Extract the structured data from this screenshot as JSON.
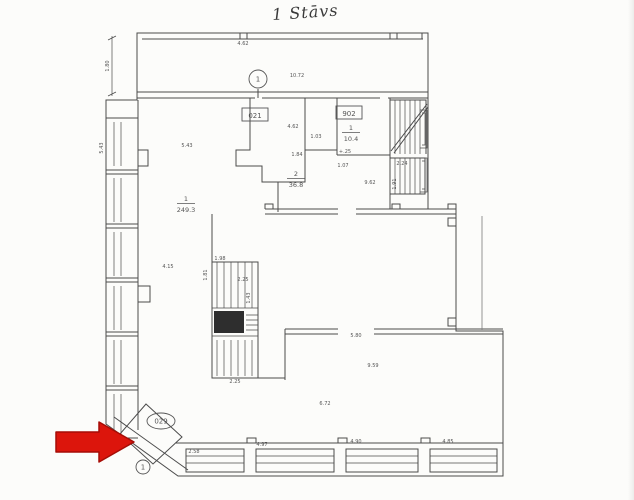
{
  "page": {
    "background": "#fcfcfa",
    "title": "1 Stāvs"
  },
  "plan": {
    "ink": "#4b4b4b",
    "label_color": "#555555",
    "rooms": [
      {
        "number": "1",
        "area": "10.4",
        "x": 351,
        "y": 130,
        "note": "+.25"
      },
      {
        "number": "2",
        "area": "36.8",
        "x": 296,
        "y": 176
      },
      {
        "number": "1",
        "area": "249.3",
        "x": 186,
        "y": 201
      }
    ],
    "boxed_labels": [
      {
        "text": "021",
        "x": 255,
        "y": 114
      },
      {
        "text": "902",
        "x": 349,
        "y": 112
      }
    ],
    "oval_labels": [
      {
        "text": "029",
        "x": 161,
        "y": 421
      }
    ],
    "circle_markers": [
      {
        "text": "1",
        "x": 258,
        "y": 79,
        "r": 9
      },
      {
        "text": "1",
        "x": 143,
        "y": 467,
        "r": 7
      }
    ],
    "dims": [
      {
        "t": "10.72",
        "x": 297,
        "y": 77
      },
      {
        "t": "4.62",
        "x": 243,
        "y": 45
      },
      {
        "t": "1.80",
        "x": 109,
        "y": 66,
        "r": -90
      },
      {
        "t": "5.43",
        "x": 103,
        "y": 148,
        "r": -90
      },
      {
        "t": "4.62",
        "x": 293,
        "y": 128
      },
      {
        "t": "1.03",
        "x": 316,
        "y": 138
      },
      {
        "t": "1.84",
        "x": 297,
        "y": 156
      },
      {
        "t": "5.43",
        "x": 187,
        "y": 147
      },
      {
        "t": "1.07",
        "x": 343,
        "y": 167
      },
      {
        "t": "2.24",
        "x": 402,
        "y": 165
      },
      {
        "t": "1.91",
        "x": 396,
        "y": 184,
        "r": -90
      },
      {
        "t": "9.62",
        "x": 370,
        "y": 184
      },
      {
        "t": "4.15",
        "x": 168,
        "y": 268
      },
      {
        "t": "1.98",
        "x": 220,
        "y": 260
      },
      {
        "t": "2.25",
        "x": 243,
        "y": 281
      },
      {
        "t": "1.43",
        "x": 250,
        "y": 298,
        "r": -90
      },
      {
        "t": "1.81",
        "x": 207,
        "y": 275,
        "r": -90
      },
      {
        "t": "2.25",
        "x": 235,
        "y": 383
      },
      {
        "t": "5.80",
        "x": 356,
        "y": 337
      },
      {
        "t": "9.59",
        "x": 373,
        "y": 367
      },
      {
        "t": "6.72",
        "x": 325,
        "y": 405
      },
      {
        "t": "2.58",
        "x": 194,
        "y": 453
      },
      {
        "t": "4.97",
        "x": 262,
        "y": 446
      },
      {
        "t": "4.90",
        "x": 356,
        "y": 443
      },
      {
        "t": "4.85",
        "x": 448,
        "y": 443
      }
    ]
  },
  "annotation": {
    "arrow_color": "#dc150c",
    "arrow_outline": "#a50d06",
    "direction": "right"
  }
}
